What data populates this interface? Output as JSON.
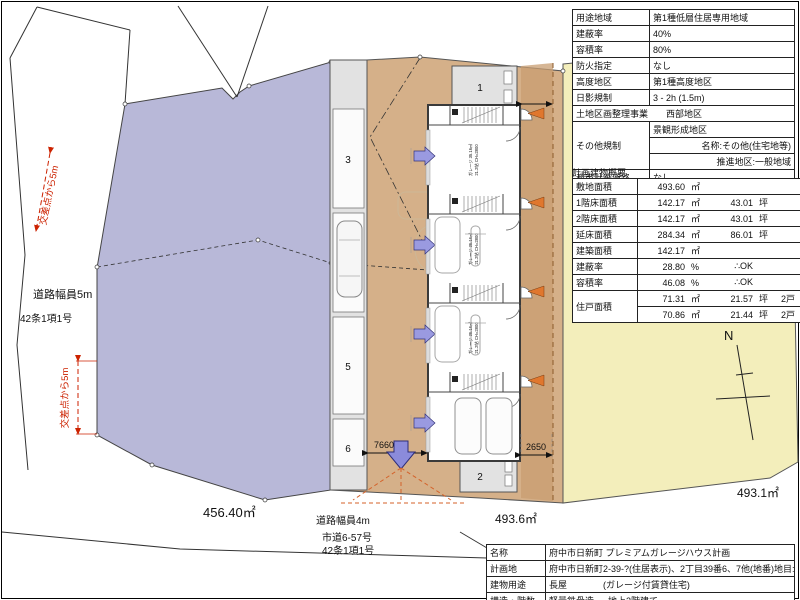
{
  "zoning": {
    "rows": [
      {
        "label": "用途地域",
        "value": "第1種低層住居専用地域"
      },
      {
        "label": "建蔽率",
        "value": "40%"
      },
      {
        "label": "容積率",
        "value": "80%"
      },
      {
        "label": "防火指定",
        "value": "なし"
      },
      {
        "label": "高度地区",
        "value": "第1種高度地区"
      },
      {
        "label": "日影規制",
        "value": "3 - 2h (1.5m)"
      },
      {
        "label": "土地区画整理事業",
        "value": "西部地区"
      },
      {
        "label": "その他規制",
        "value": "景観形成地区"
      },
      {
        "label": "",
        "value": "名称:その他(住宅地等)"
      },
      {
        "label": "",
        "value": "推進地区:一般地域"
      },
      {
        "label": "都市計画道路",
        "value": "なし"
      }
    ]
  },
  "building_summary": {
    "title": "計画建物概要",
    "rows": [
      {
        "label": "敷地面積",
        "v1": "493.60",
        "u1": "㎡",
        "v2": "",
        "u2": "",
        "extra": ""
      },
      {
        "label": "1階床面積",
        "v1": "142.17",
        "u1": "㎡",
        "v2": "43.01",
        "u2": "坪",
        "extra": ""
      },
      {
        "label": "2階床面積",
        "v1": "142.17",
        "u1": "㎡",
        "v2": "43.01",
        "u2": "坪",
        "extra": ""
      },
      {
        "label": "延床面積",
        "v1": "284.34",
        "u1": "㎡",
        "v2": "86.01",
        "u2": "坪",
        "extra": ""
      },
      {
        "label": "建築面積",
        "v1": "142.17",
        "u1": "㎡",
        "v2": "",
        "u2": "",
        "extra": ""
      },
      {
        "label": "建蔽率",
        "v1": "28.80",
        "u1": "%",
        "v2": "∴OK",
        "u2": "",
        "extra": ""
      },
      {
        "label": "容積率",
        "v1": "46.08",
        "u1": "%",
        "v2": "∴OK",
        "u2": "",
        "extra": ""
      },
      {
        "label": "住戸面積",
        "v1": "71.31",
        "u1": "㎡",
        "v2": "21.57",
        "u2": "坪",
        "extra": "2戸"
      },
      {
        "label": "",
        "v1": "70.86",
        "u1": "㎡",
        "v2": "21.44",
        "u2": "坪",
        "extra": "2戸"
      }
    ]
  },
  "project": {
    "rows": [
      {
        "label": "名称",
        "value": "府中市日新町 プレミアムガレージハウス計画",
        "note": ""
      },
      {
        "label": "計画地",
        "value": "府中市日新町2-39-?(住居表示)、2丁目39番6、7他(地番)",
        "note": "地目:田?"
      },
      {
        "label": "建物用途",
        "value": "長屋",
        "note": "(ガレージ付賃貸住宅)"
      },
      {
        "label": "構造・階数",
        "value": "軽量鉄骨造",
        "note": "地上2階建て"
      }
    ]
  },
  "plan": {
    "north": "N",
    "area_left": "456.40㎡",
    "area_site": "493.6㎡",
    "area_right": "493.1㎡",
    "road_left_width": "道路幅員5m",
    "road_left_article": "42条1項1号",
    "road_bottom_width": "道路幅員4m",
    "road_bottom_name": "市道6-57号",
    "road_bottom_article": "42条1項1号",
    "note_intersection_top": "交差点から5m",
    "note_intersection_bottom": "交差点から5m",
    "dim_7660": "7660",
    "dim_2650": "2650",
    "stall_labels": {
      "s1": "1",
      "s2": "2",
      "s3": "3",
      "s4": "4",
      "s5": "5",
      "s6": "6"
    },
    "garage_label": {
      "line1": "ガレージ 35.16㎡",
      "line2": "21.2帖 CH=2800"
    }
  },
  "colors": {
    "site_fill": "#d5b089",
    "left_lot_fill": "#b8b8d8",
    "right_lot_fill": "#f3eebb",
    "accent_orange": "#e0772e",
    "accent_blue": "#8b8bdb",
    "annotation_red": "#cc2200"
  }
}
